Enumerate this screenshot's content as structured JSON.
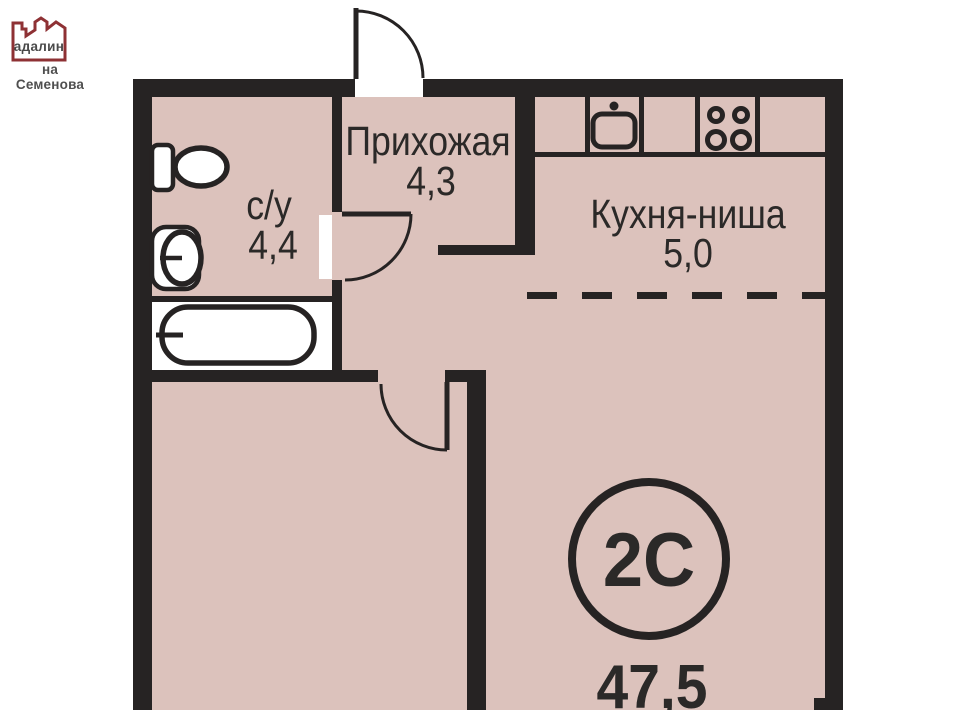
{
  "logo": {
    "brand": "адалин",
    "subtitle": "на Семенова"
  },
  "rooms": {
    "hallway": {
      "name": "Прихожая",
      "area": "4,3"
    },
    "bathroom": {
      "name": "с/у",
      "area": "4,4"
    },
    "kitchen": {
      "name": "Кухня-ниша",
      "area": "5,0"
    }
  },
  "unit": {
    "type": "2С",
    "total_area": "47,5"
  },
  "colors": {
    "floor": "#dcc2bc",
    "wall": "#262323",
    "ink": "#2b2928",
    "accent": "#8e3134"
  }
}
